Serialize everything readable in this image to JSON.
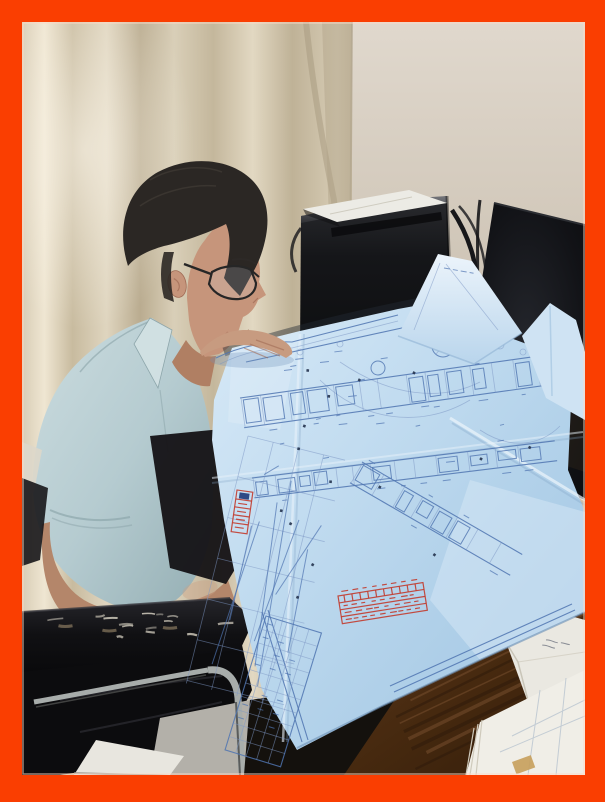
{
  "scene": {
    "type": "photograph",
    "setting": "office interior",
    "description": "Photo with a thick orange border: a man with short dark hair and eyeglasses, wearing a light blue polo shirt, leans over a desk studying a large folded light-blue architectural blueprint. Behind him are beige curtains, a black PC tower with a white paper on top, and a black monitor. A worn black leather office chair with chrome frame is at lower left; a dark wooden desk with white papers and a folded envelope is at lower right.",
    "elements": [
      {
        "name": "orange-frame",
        "desc": "thick orange-red border around photo"
      },
      {
        "name": "curtain",
        "desc": "beige pleated curtain background"
      },
      {
        "name": "wall",
        "desc": "light beige wall panel, upper right"
      },
      {
        "name": "pc-tower",
        "desc": "black desktop tower with white paper sheet on top"
      },
      {
        "name": "monitor",
        "desc": "black monitor screen, right side"
      },
      {
        "name": "man",
        "desc": "man in profile, glasses, light blue polo, studying blueprint"
      },
      {
        "name": "blueprint",
        "desc": "large folded light-blue construction drawing with dense blue linework, red stamps (text illegible), title-block table"
      },
      {
        "name": "office-chair",
        "desc": "black leather chair with scuffed armrest and chrome frame"
      },
      {
        "name": "floor-paper",
        "desc": "white paper scrap on gray floor"
      },
      {
        "name": "desk",
        "desc": "dark brown wooden desk corner"
      },
      {
        "name": "papers",
        "desc": "stack of white printed sheets and folded envelope with faint handwriting"
      }
    ],
    "legible_text": "none — all stamp and drawing text too small to read"
  },
  "palette": {
    "frame": "#fa3e01",
    "frameEdge": "#ffd9c4",
    "curtain": "#cfc2a8",
    "curtainLight": "#e6dcc7",
    "curtainShadow": "#b2a489",
    "wall": "#ddd5ca",
    "wallSeam": "#b2a68f",
    "towerBody": "#1a1b1e",
    "towerTop": "#6a6b6f",
    "towerPaper": "#ecebe5",
    "monitor": "#101114",
    "hair": "#2b2724",
    "skin": "#c6957b",
    "skinShadow": "#a06b55",
    "skinArm": "#b4866a",
    "skinHand": "#c79b80",
    "shirt": "#b5cbd0",
    "shirtLight": "#d2e1e3",
    "shirtShadow": "#8ba4a9",
    "leather": "#0d0d0f",
    "leatherHi": "#35353b",
    "scuff": "#d8d2c3",
    "chrome": "#a8adab",
    "chromeDark": "#5a5c5b",
    "floor": "#b3b0a9",
    "floorPaper": "#e8e6df",
    "wood": "#4a2d17",
    "woodDark": "#2e1a0b",
    "woodLight": "#7a5130",
    "paperWhite": "#eae8e1",
    "paperShadow": "#c9c5b8",
    "inkFaint": "#8a8d95",
    "bpLight": "#d7e9f7",
    "bpMid": "#b3d2ea",
    "bpDeep": "#9fc4e2",
    "bpLine": "#4f74b0",
    "bpLineFaint": "#7d98c4",
    "bpDot": "#23324d",
    "stampRed": "#c23b2e",
    "stampBlue": "#1f3a7a",
    "creaseLight": "#e8f2fa",
    "creaseShadow": "#84a7c8"
  }
}
